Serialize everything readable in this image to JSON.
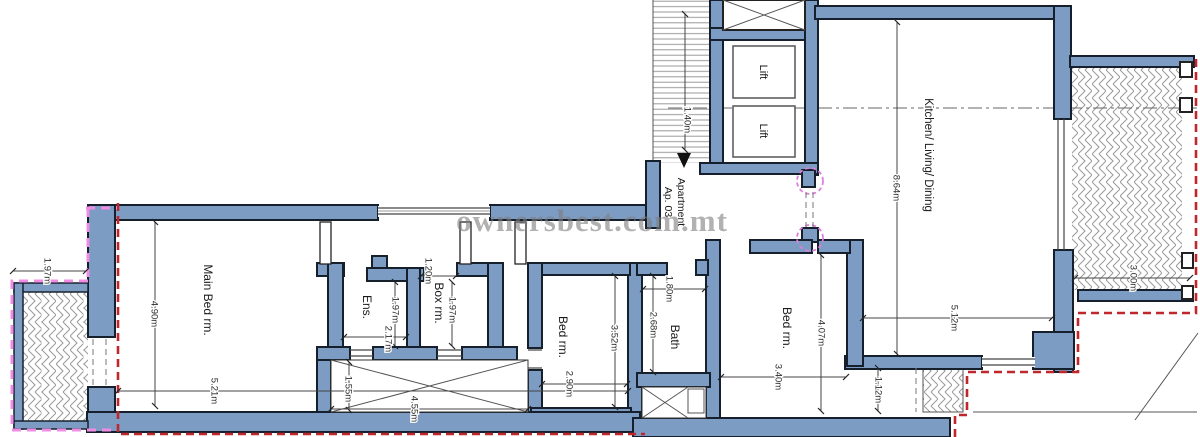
{
  "watermark": "ownersbest.com.mt",
  "apartment": {
    "line1": "Apartment",
    "line2": "Ap. 03"
  },
  "rooms": [
    {
      "id": "main-bedroom",
      "label": "Main Bed rm."
    },
    {
      "id": "ensuite",
      "label": "Ens."
    },
    {
      "id": "box-room",
      "label": "Box rm."
    },
    {
      "id": "bedroom-middle",
      "label": "Bed rm."
    },
    {
      "id": "bathroom",
      "label": "Bath"
    },
    {
      "id": "bedroom-right",
      "label": "Bed rm."
    },
    {
      "id": "kitchen-living-dining",
      "label": "Kitchen/ Living/ Dining"
    },
    {
      "id": "lift-1",
      "label": "Lift"
    },
    {
      "id": "lift-2",
      "label": "Lift"
    }
  ],
  "dims": [
    {
      "id": "stairs-width",
      "label": "1.40m"
    },
    {
      "id": "kitchen-length",
      "label": "8.64m"
    },
    {
      "id": "kitchen-width",
      "label": "5.12m"
    },
    {
      "id": "terrace-right-width",
      "label": "3.00m"
    },
    {
      "id": "balcony-left-width",
      "label": "1.97m"
    },
    {
      "id": "main-bedroom-depth",
      "label": "4.90m"
    },
    {
      "id": "main-bedroom-width",
      "label": "5.21m"
    },
    {
      "id": "ensuite-width",
      "label": "2.17m"
    },
    {
      "id": "ensuite-depth",
      "label": "1.97m"
    },
    {
      "id": "box-room-width",
      "label": "1.20m"
    },
    {
      "id": "box-room-depth",
      "label": "1.97m"
    },
    {
      "id": "yard-depth",
      "label": "1.55m"
    },
    {
      "id": "yard-width",
      "label": "4.55m"
    },
    {
      "id": "bedroom-middle-width",
      "label": "2.90m"
    },
    {
      "id": "bedroom-middle-depth",
      "label": "3.52m"
    },
    {
      "id": "bath-width",
      "label": "1.80m"
    },
    {
      "id": "bath-depth",
      "label": "2.68m"
    },
    {
      "id": "bedroom-right-width",
      "label": "3.40m"
    },
    {
      "id": "bedroom-right-depth",
      "label": "4.07m"
    },
    {
      "id": "strip-width",
      "label": "1.12m"
    }
  ],
  "colors": {
    "wall_fill": "#7d9cc3",
    "wall_outline": "#16202c",
    "boundary_red": "#c0272d",
    "boundary_pink": "#f08ce4",
    "door_marker_pink": "#dd7ddd",
    "hatch_gray": "#9a9a9a",
    "watermark_gray": "#7d7d7d"
  }
}
